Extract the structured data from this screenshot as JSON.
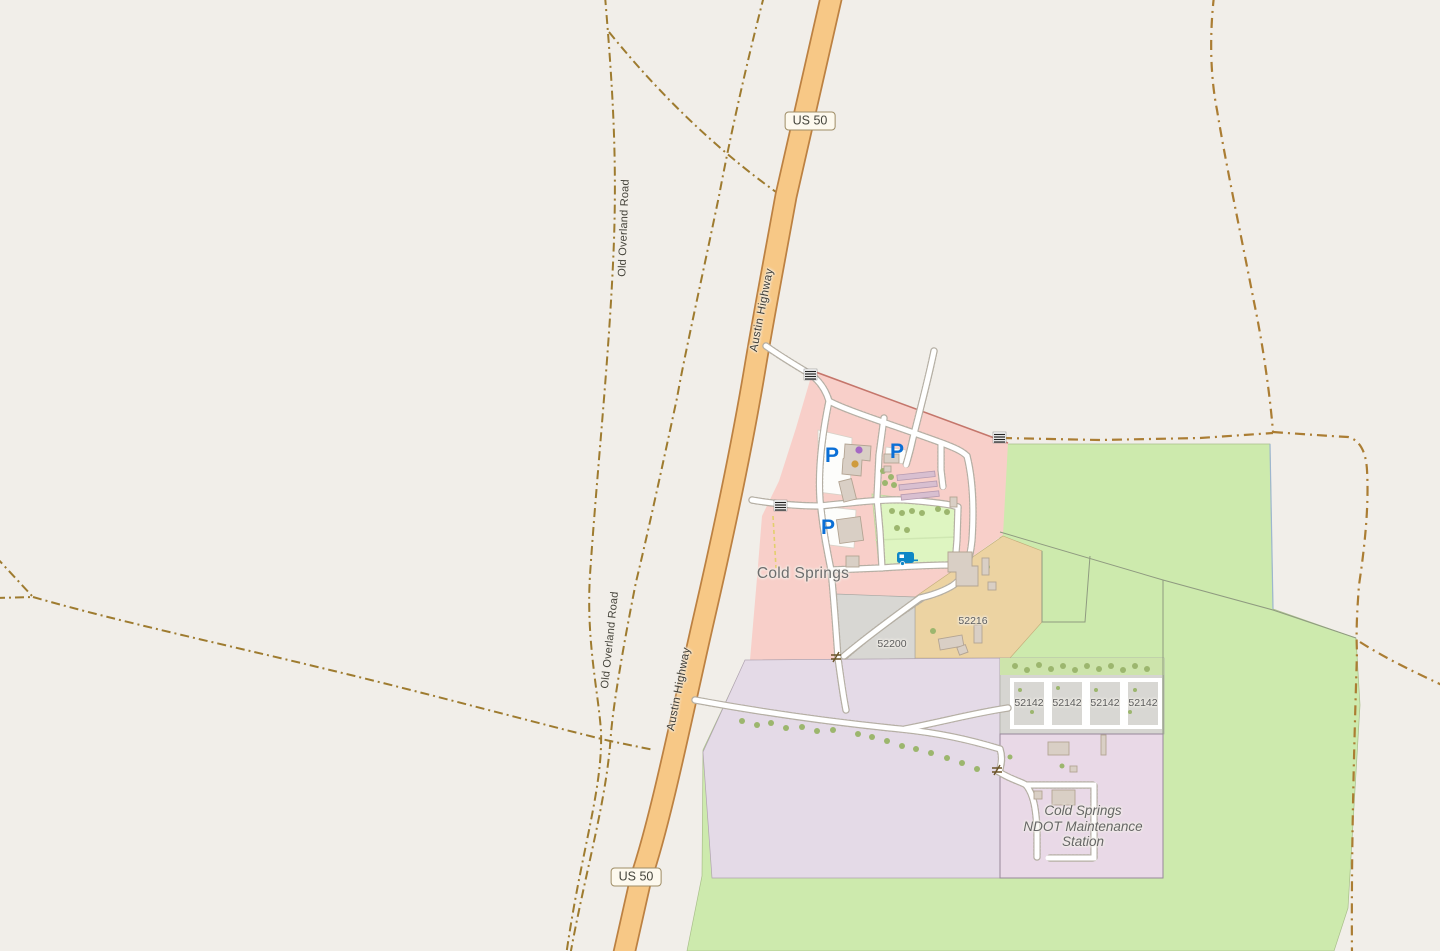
{
  "map": {
    "type": "openstreetmap-style rendered map",
    "place": "Cold Springs settlement along US 50 / Austin Highway"
  },
  "labels": {
    "route_shield": "US 50",
    "highway_name": "Austin Highway",
    "track_name": "Old Overland Road",
    "place_name": "Cold Springs",
    "housenumber_52200": "52200",
    "housenumber_52216": "52216",
    "housenumber_52142": "52142",
    "ndot_line1": "Cold Springs",
    "ndot_line2": "NDOT Maintenance",
    "ndot_line3": "Station"
  },
  "icons": {
    "parking_letter": "P",
    "gate_symbol": "≠"
  },
  "colors": {
    "background": "#f1eee9",
    "highway_fill": "#f7c886",
    "highway_casing": "#bc8142",
    "track_dash": "#9e7b2f",
    "residential_pink": "#f8cfc9",
    "grass_green": "#cdeaad",
    "campsite_green": "#def5c1",
    "industrial_lavender": "#e4dae7",
    "ndot_parcel": "#e9d9e7",
    "construction_orange": "#ecd3a2",
    "parcel_gray": "#d8d7d3",
    "building": "#d9cfc5",
    "parking_blue": "#0b6fd6",
    "caravan_blue": "#0e87c6"
  }
}
